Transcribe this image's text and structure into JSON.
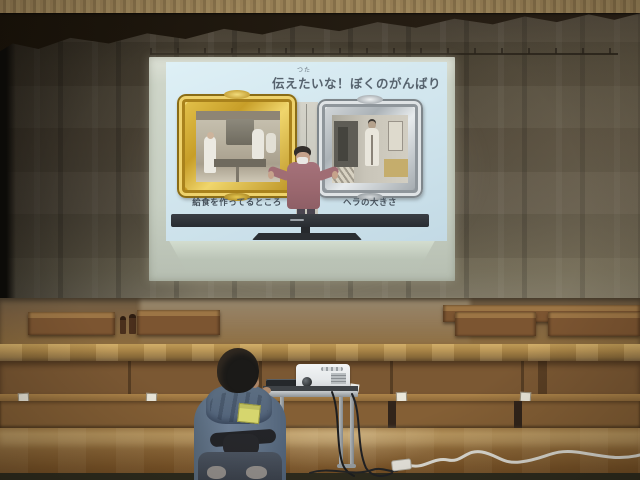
{
  "photo": {
    "setting": "school gymnasium stage with projection screen, seated student and projector table",
    "slide": {
      "furigana": "つた",
      "title": "伝えたいな！ぼくのがんばり",
      "captions": {
        "left": "給食を作ってるところ",
        "right": "ヘラの大きさ"
      }
    },
    "colors": {
      "curtain": "#584f3f",
      "valance": "#1e1812",
      "proscenium_beam": "#937b52",
      "screen": "#ccd3c5",
      "slide_background": "#d2e6ee",
      "gold_frame": "#d7b63e",
      "silver_frame": "#c7ccd0",
      "stage_wood": "#b28c4b",
      "bench_wood": "#845f35",
      "gym_floor": "#8c6636",
      "hoodie_blue": "#697a8d",
      "name_tag_yellow": "#d6d66e",
      "projector_white": "#eceeef",
      "extension_cord": "#e3e2da"
    }
  }
}
